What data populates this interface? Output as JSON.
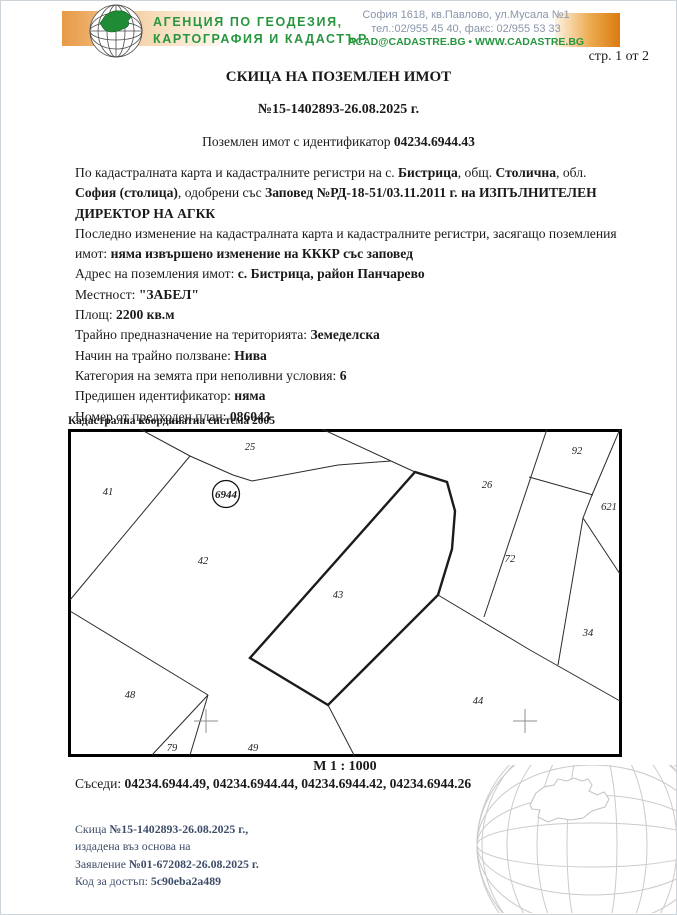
{
  "colors": {
    "agency_green": "#27963f",
    "orange_dark": "#d97b10",
    "orange_light": "#fdf3e3",
    "contact_gray_blue": "#8a96ab",
    "footer_navy": "#3d4d69",
    "map_line": "#2b2b2b"
  },
  "header": {
    "agency_line1": "АГЕНЦИЯ ПО ГЕОДЕЗИЯ,",
    "agency_line2": "КАРТОГРАФИЯ И КАДАСТЪР",
    "address": "София 1618, кв.Павлово, ул.Мусала №1",
    "phone": "тел.:02/955 45 40, факс: 02/955 53 33",
    "web": "ACAD@CADASTRE.BG • WWW.CADASTRE.BG"
  },
  "page_label": "стр. 1 от 2",
  "title": {
    "main": "СКИЦА НА ПОЗЕМЛЕН ИМОТ",
    "number": "№15-1402893-26.08.2025 г.",
    "property_id": [
      {
        "t": "Поземлен имот с идентификатор "
      },
      {
        "t": "04234.6944.43",
        "b": true
      }
    ]
  },
  "body": {
    "paragraph1": [
      {
        "t": "По кадастралната карта и кадастралните регистри на с. "
      },
      {
        "t": "Бистрица",
        "b": true
      },
      {
        "t": ", общ. "
      },
      {
        "t": "Столична",
        "b": true
      },
      {
        "t": ", обл. "
      },
      {
        "t": "София (столица)",
        "b": true
      },
      {
        "t": ", одобрени със "
      },
      {
        "t": "Заповед №РД-18-51/03.11.2011 г. на ИЗПЪЛНИТЕЛЕН ДИРЕКТОР НА АГКК",
        "b": true
      }
    ],
    "paragraph2": [
      {
        "t": "Последно изменение на кадастралната карта и кадастралните регистри, засягащо поземления имот: "
      },
      {
        "t": "няма извършено изменение на КККР със заповед",
        "b": true
      }
    ],
    "fields": [
      [
        {
          "t": "Адрес на поземления имот: "
        },
        {
          "t": "с. Бистрица, район Панчарево",
          "b": true
        }
      ],
      [
        {
          "t": "Местност: "
        },
        {
          "t": "\"ЗАБЕЛ\"",
          "b": true
        }
      ],
      [
        {
          "t": "Площ: "
        },
        {
          "t": "2200 кв.м",
          "b": true
        }
      ],
      [
        {
          "t": "Трайно предназначение на територията: "
        },
        {
          "t": "Земеделска",
          "b": true
        }
      ],
      [
        {
          "t": "Начин на трайно ползване: "
        },
        {
          "t": "Нива",
          "b": true
        }
      ],
      [
        {
          "t": "Категория на земята при неполивни условия: "
        },
        {
          "t": "6",
          "b": true
        }
      ],
      [
        {
          "t": "Предишен идентификатор: "
        },
        {
          "t": "няма",
          "b": true
        }
      ],
      [
        {
          "t": "Номер от предходен план: "
        },
        {
          "t": "086043",
          "b": true
        }
      ]
    ]
  },
  "map": {
    "coordinate_system": "Кадастрална координатна система 2005",
    "scale": "М 1 : 1000",
    "subject_label": "6944",
    "labels": [
      "25",
      "41",
      "42",
      "43",
      "26",
      "92",
      "621",
      "72",
      "34",
      "48",
      "79",
      "49",
      "44"
    ]
  },
  "neighbors": [
    {
      "t": "Съседи: "
    },
    {
      "t": "04234.6944.49, 04234.6944.44, 04234.6944.42, 04234.6944.26",
      "b": true
    }
  ],
  "footer": {
    "lines": [
      [
        {
          "t": "Скица "
        },
        {
          "t": "№15-1402893-26.08.2025 г.,",
          "b": true
        }
      ],
      [
        {
          "t": "издадена въз основа на"
        }
      ],
      [
        {
          "t": "Заявление "
        },
        {
          "t": "№01-672082-26.08.2025 г.",
          "b": true
        }
      ],
      [
        {
          "t": "Код за достъп: "
        },
        {
          "t": "5c90eba2a489",
          "b": true
        }
      ]
    ]
  }
}
